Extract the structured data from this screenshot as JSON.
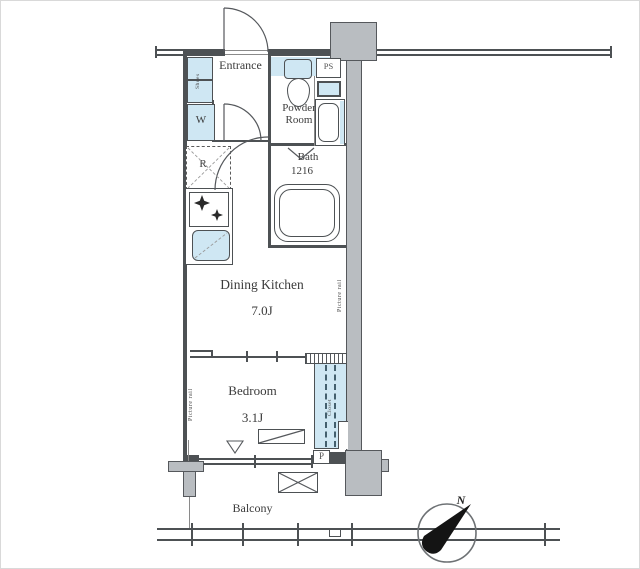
{
  "floorplan": {
    "rooms": {
      "entrance": "Entrance",
      "powder1": "Powder",
      "powder2": "Room",
      "bath": "Bath",
      "bath_size": "1216",
      "dk": "Dining Kitchen",
      "dk_size": "7.0J",
      "bedroom": "Bedroom",
      "bedroom_size": "3.1J",
      "balcony": "Balcony"
    },
    "fixtures": {
      "shoes": "Shoes",
      "washer": "W",
      "fridge": "R",
      "ps": "PS",
      "p": "P",
      "closet": "Closet",
      "rail_right": "Picture rail",
      "rail_left": "Picture rail"
    },
    "compass": {
      "n": "N"
    },
    "colors": {
      "fixture_blue": "#cfe7f3",
      "wall_gray": "#b9bdc1",
      "line_dark": "#4d5154"
    }
  }
}
